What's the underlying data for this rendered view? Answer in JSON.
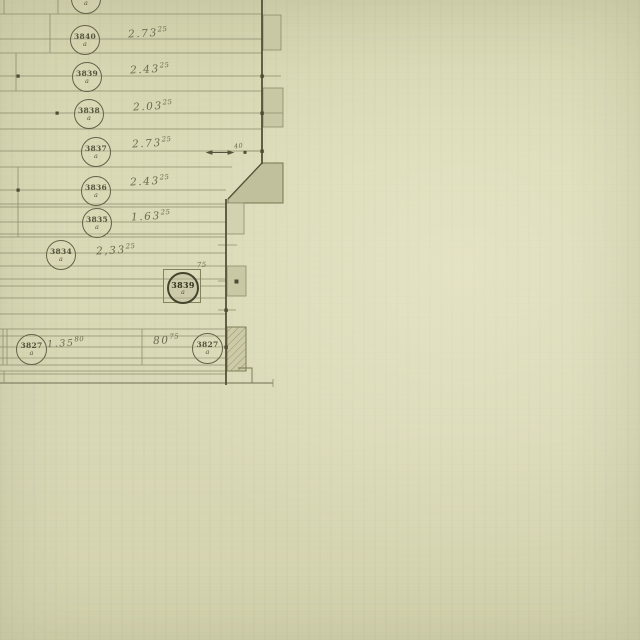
{
  "drawing": {
    "colors": {
      "paper": "#d9d8b6",
      "line": "#8e8d6c",
      "wall": "#53523a",
      "ink": "#6b6a4e",
      "shade": "#c9c8a5"
    },
    "rows": [
      {
        "label": "3841",
        "suffix": "a",
        "value": "",
        "sup": ""
      },
      {
        "label": "3840",
        "suffix": "a",
        "value": "2.73",
        "sup": "25"
      },
      {
        "label": "3839",
        "suffix": "a",
        "value": "2.43",
        "sup": "25"
      },
      {
        "label": "3838",
        "suffix": "a",
        "value": "2.03",
        "sup": "25"
      },
      {
        "label": "3837",
        "suffix": "a",
        "value": "2.73",
        "sup": "25"
      },
      {
        "label": "3836",
        "suffix": "a",
        "value": "2.43",
        "sup": "25"
      },
      {
        "label": "3835",
        "suffix": "a",
        "value": "1.63",
        "sup": "25"
      },
      {
        "label": "3834",
        "suffix": "a",
        "value": "2,33",
        "sup": "25"
      },
      {
        "label": "3839",
        "suffix": "a",
        "value": "",
        "sup": "75",
        "boxed": true
      }
    ],
    "bottom_row": {
      "left_label": "3827",
      "left_suffix": "a",
      "left_value": "1.35",
      "left_sup": "80",
      "right_value": "80",
      "right_sup": "75",
      "right_label": "3827",
      "right_suffix": "a"
    },
    "dimension_40": "40"
  }
}
